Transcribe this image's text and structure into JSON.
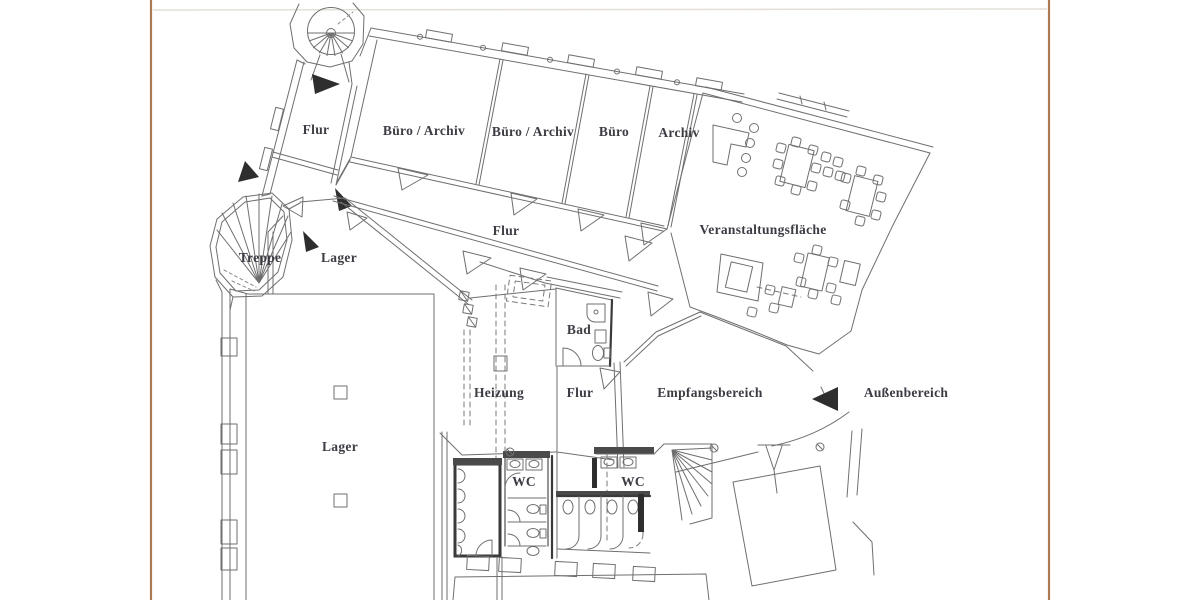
{
  "page": {
    "kind": "scanned floor plan",
    "background": "#ffffff"
  },
  "colors": {
    "frame_line": "#ad7952",
    "plan_line": "#6f6f6f",
    "plan_dark": "#3a3a3a",
    "label_text": "#3c3c44",
    "paper": "#ffffff"
  },
  "labels": {
    "rooms": [
      {
        "id": "flur-oben",
        "text": "Flur",
        "x": 316,
        "y": 131
      },
      {
        "id": "buero-archiv-1",
        "text": "Büro / Archiv",
        "x": 424,
        "y": 132
      },
      {
        "id": "buero-archiv-2",
        "text": "Büro / Archiv",
        "x": 533,
        "y": 133
      },
      {
        "id": "buero",
        "text": "Büro",
        "x": 614,
        "y": 133
      },
      {
        "id": "archiv",
        "text": "Archiv",
        "x": 679,
        "y": 134
      },
      {
        "id": "flur-korridor",
        "text": "Flur",
        "x": 506,
        "y": 232
      },
      {
        "id": "veranstaltungsflaeche",
        "text": "Veranstaltungsfläche",
        "x": 763,
        "y": 231
      },
      {
        "id": "treppe",
        "text": "Treppe",
        "x": 260,
        "y": 259
      },
      {
        "id": "lager-klein",
        "text": "Lager",
        "x": 339,
        "y": 259
      },
      {
        "id": "bad",
        "text": "Bad",
        "x": 579,
        "y": 331
      },
      {
        "id": "heizung",
        "text": "Heizung",
        "x": 499,
        "y": 394
      },
      {
        "id": "flur-mitte",
        "text": "Flur",
        "x": 580,
        "y": 394
      },
      {
        "id": "empfangsbereich",
        "text": "Empfangsbereich",
        "x": 710,
        "y": 394
      },
      {
        "id": "aussenbereich",
        "text": "Außenbereich",
        "x": 906,
        "y": 394
      },
      {
        "id": "lager-gross",
        "text": "Lager",
        "x": 340,
        "y": 448
      },
      {
        "id": "wc-links",
        "text": "WC",
        "x": 524,
        "y": 483
      },
      {
        "id": "wc-rechts",
        "text": "WC",
        "x": 633,
        "y": 483
      }
    ]
  }
}
